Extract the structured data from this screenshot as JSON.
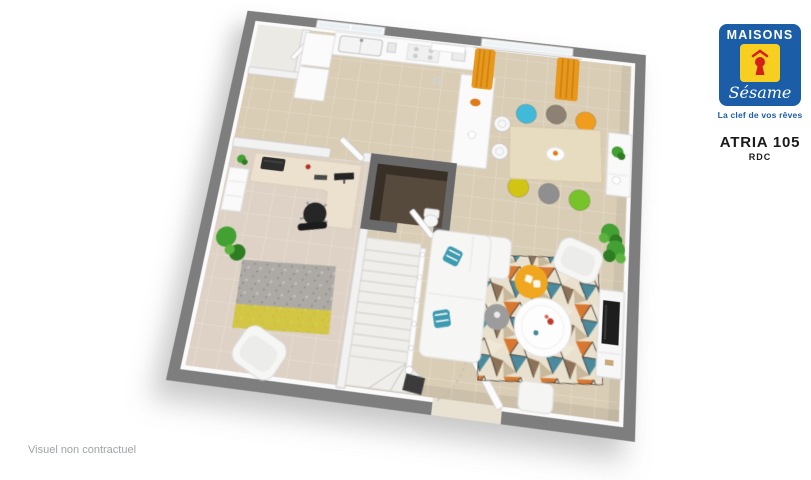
{
  "brand": {
    "name_top": "MAISONS",
    "name_script": "Sésame",
    "tagline": "La clef de vos rêves",
    "logo_icon": "keyhole-icon"
  },
  "plan": {
    "model": "ATRIA 105",
    "level": "RDC"
  },
  "footer": {
    "disclaimer": "Visuel non contractuel"
  },
  "colors": {
    "brand-blue": "#1b5da7",
    "brand-yellow": "#f6cf20",
    "brand-red": "#d42019",
    "wall-gray": "#7e7e7e",
    "inner-wall": "#f2f2f2",
    "floor-beige": "#d9cdb6",
    "floor-grout": "#e7decb",
    "office-floor": "#ddd2c5",
    "wood": "#e8dcc0",
    "curtain-orange": "#e8981d",
    "plant-green": "#43a032",
    "pouf-yellow": "#f0a61e",
    "tv-black": "#1d1d1d",
    "chair-cyan": "#41b9d9",
    "chair-taupe": "#8d8173",
    "chair-orange": "#f09d1d",
    "chair-yellow": "#d2c413",
    "chair-gray": "#8f8f8f",
    "chair-green": "#76c32a",
    "rug-yellow": "#e3d11c",
    "wc-floor": "#564a3d",
    "text-gray": "#9fa3a7"
  }
}
